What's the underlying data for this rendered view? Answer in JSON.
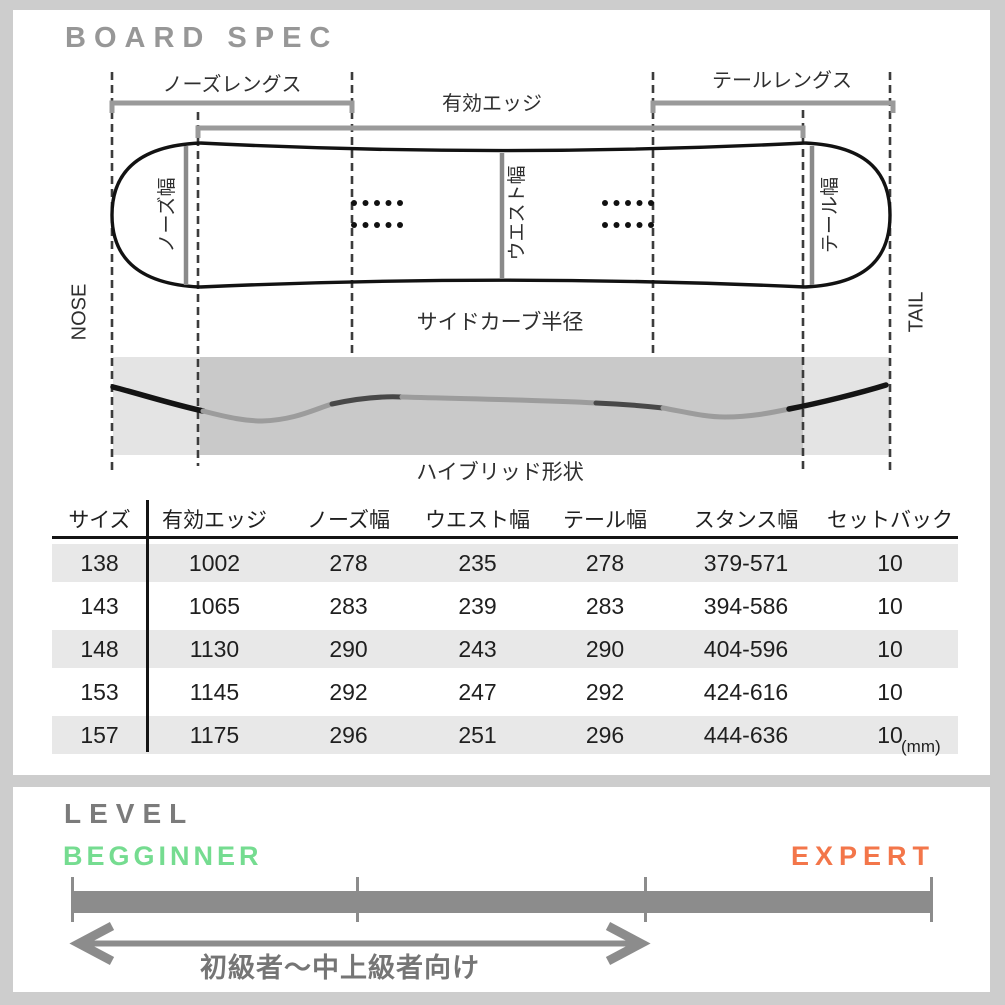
{
  "board_spec": {
    "title": "BOARD SPEC",
    "diagram": {
      "labels": {
        "nose_length": "ノーズレングス",
        "effective_edge": "有効エッジ",
        "tail_length": "テールレングス",
        "nose_width": "ノーズ幅",
        "waist_width": "ウエスト幅",
        "tail_width": "テール幅",
        "nose": "NOSE",
        "tail": "TAIL",
        "sidecut_radius": "サイドカーブ半径",
        "camber_shape": "ハイブリッド形状"
      }
    },
    "table": {
      "columns": [
        "サイズ",
        "有効エッジ",
        "ノーズ幅",
        "ウエスト幅",
        "テール幅",
        "スタンス幅",
        "セットバック"
      ],
      "rows": [
        [
          "138",
          "1002",
          "278",
          "235",
          "278",
          "379-571",
          "10"
        ],
        [
          "143",
          "1065",
          "283",
          "239",
          "283",
          "394-586",
          "10"
        ],
        [
          "148",
          "1130",
          "290",
          "243",
          "290",
          "404-596",
          "10"
        ],
        [
          "153",
          "1145",
          "292",
          "247",
          "292",
          "424-616",
          "10"
        ],
        [
          "157",
          "1175",
          "296",
          "251",
          "296",
          "444-636",
          "10"
        ]
      ],
      "unit_note": "(mm)"
    }
  },
  "level": {
    "title": "LEVEL",
    "beginner_label": "BEGGINNER",
    "expert_label": "EXPERT",
    "range_note": "初級者～中上級者向け",
    "colors": {
      "beginner": "#75dc90",
      "expert": "#f3764a",
      "scale": "#8c8c8c"
    }
  }
}
